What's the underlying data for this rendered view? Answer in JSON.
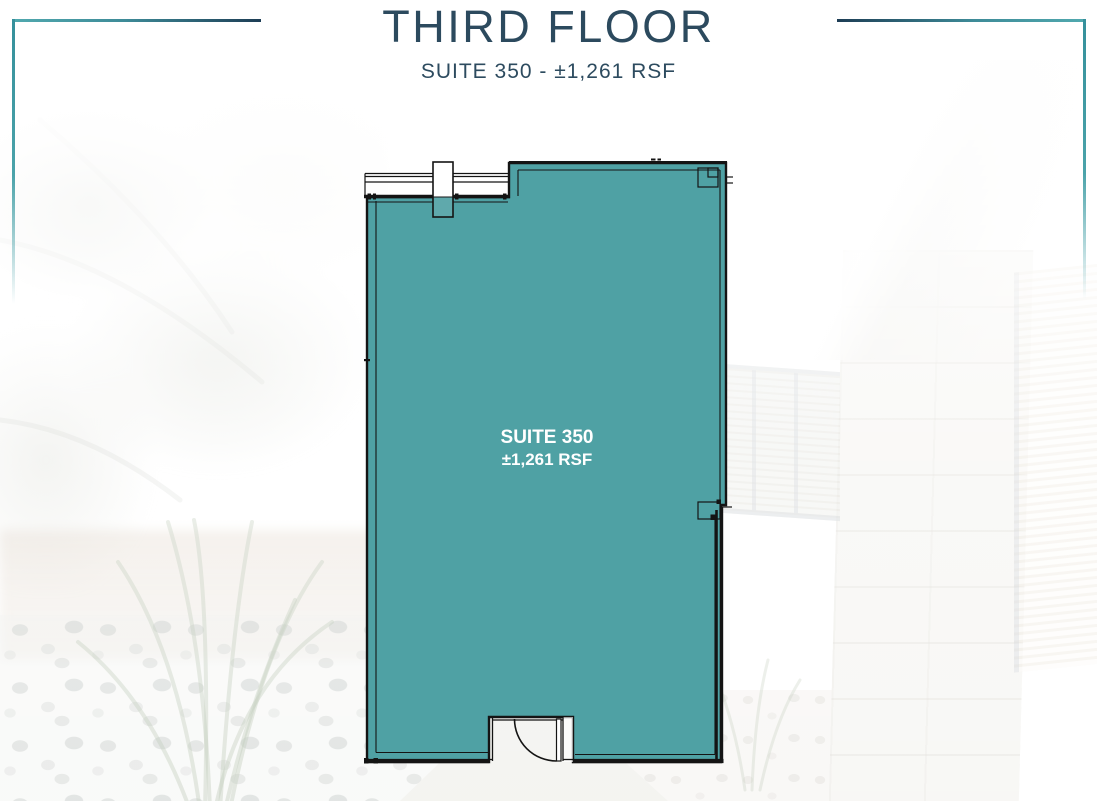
{
  "header": {
    "title": "THIRD FLOOR",
    "subtitle": "SUITE 350 - ±1,261 RSF"
  },
  "plan": {
    "label_line1": "SUITE 350",
    "label_line2": "±1,261 RSF"
  },
  "colors": {
    "suite_fill": "#4FA1A4",
    "title_navy": "#2C4A5E",
    "bracket_teal": "#4BA3AA",
    "bracket_navy": "#1D3D55",
    "wall_line": "#141414",
    "label_text": "#FFFFFF"
  }
}
